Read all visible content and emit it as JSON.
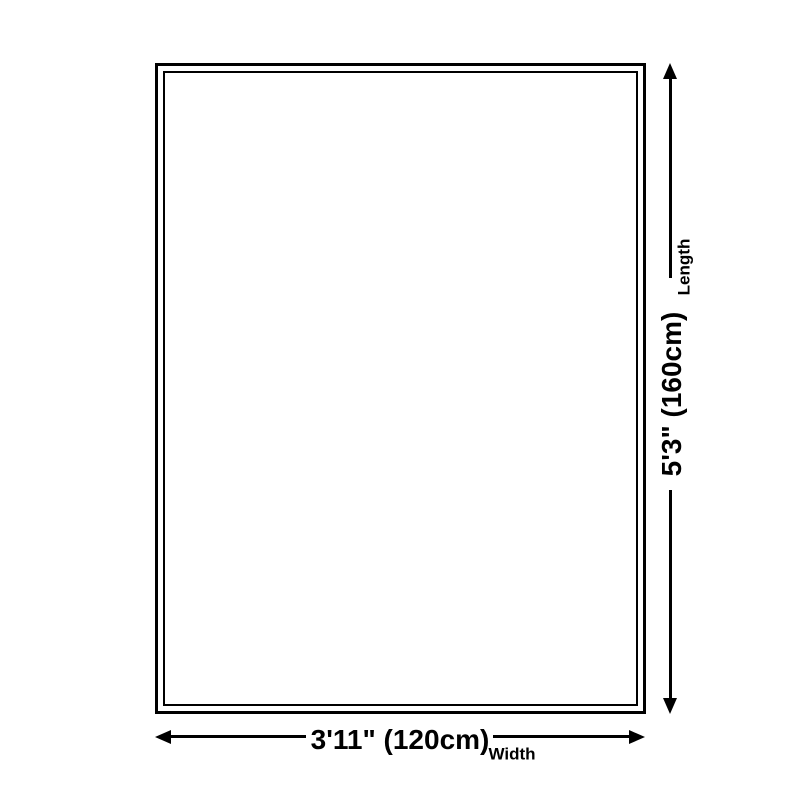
{
  "diagram": {
    "title": "rug-size-diagram",
    "length": {
      "label": "Length",
      "value": "5'3\" (160cm)"
    },
    "width": {
      "label": "Width",
      "value": "3'11\" (120cm)"
    },
    "colors": {
      "line": "#000000",
      "background": "#ffffff"
    }
  }
}
